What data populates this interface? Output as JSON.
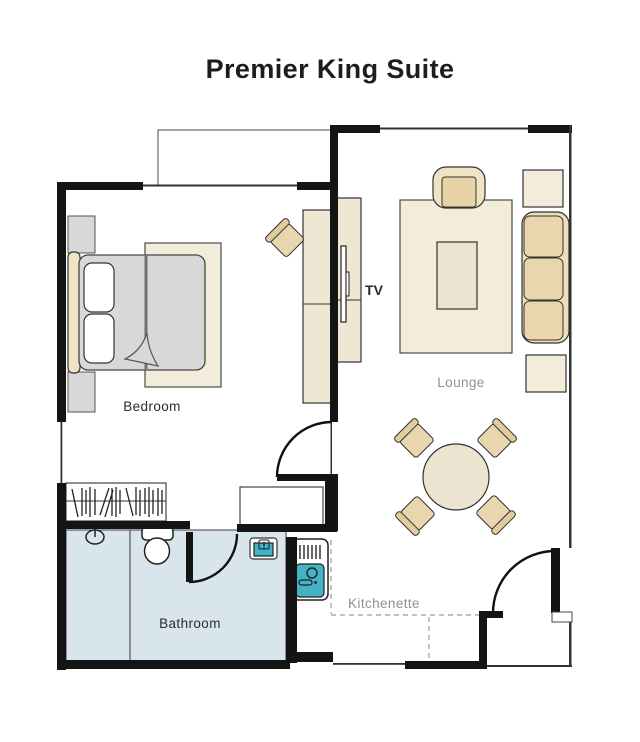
{
  "title": "Premier King Suite",
  "labels": {
    "bedroom": "Bedroom",
    "lounge": "Lounge",
    "bathroom": "Bathroom",
    "kitchenette": "Kitchenette",
    "tv": "TV"
  },
  "colors": {
    "wall": "#141414",
    "furniture_beige": "#e9d6ae",
    "rug_beige": "#f4ecda",
    "wood_light": "#efe7d3",
    "bed_gray": "#d8d8d8",
    "bathroom_blue": "#d9e5ec",
    "sink_teal": "#43b3c5",
    "label_dark": "#2b2b2b",
    "label_gray": "#8d9094"
  }
}
